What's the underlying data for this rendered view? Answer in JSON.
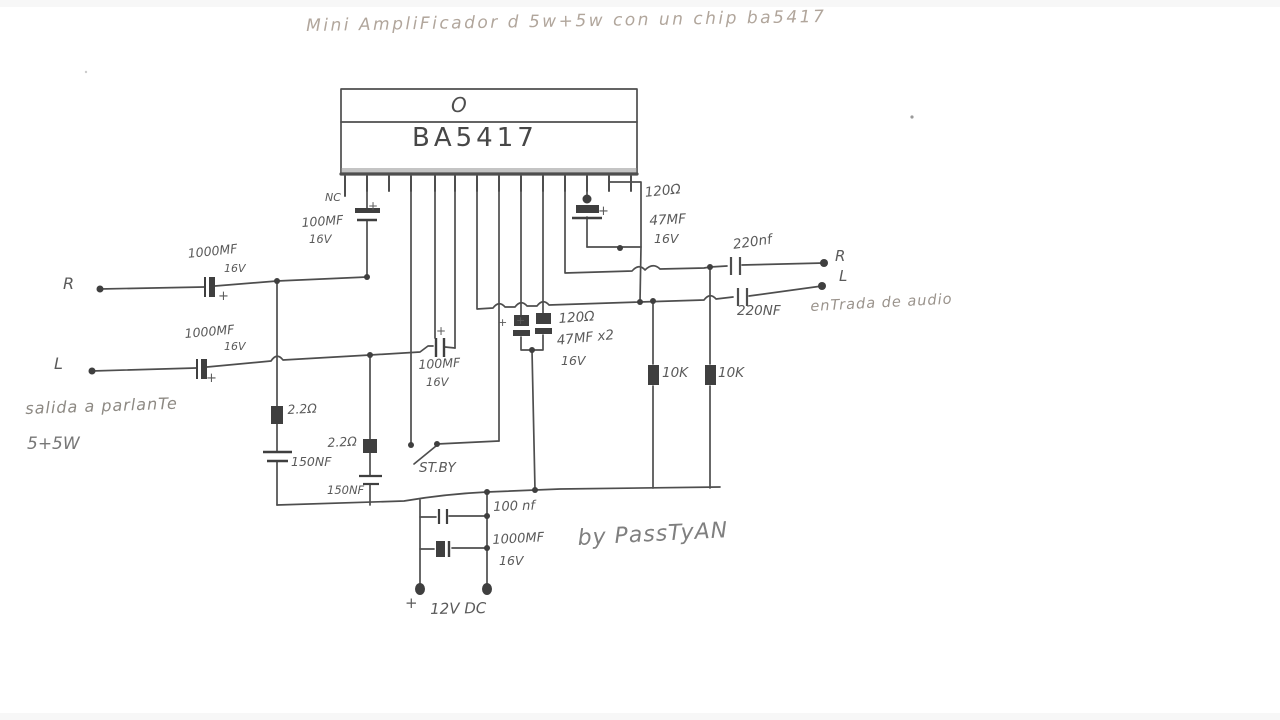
{
  "title": "Mini AmpliFicador d 5w+5w con un chip ba5417",
  "ic": {
    "part": "BA5417",
    "pin1_mark": "O"
  },
  "credit": "by PassTyAN",
  "polarity_mark": "+",
  "io": {
    "output_r": "R",
    "output_l": "L",
    "output_caption": "salida a parlanTe",
    "output_rating": "5+5W",
    "input_r": "R",
    "input_l": "L",
    "input_caption": "enTrada de audio"
  },
  "components": {
    "nc": "NC",
    "c_top_left": {
      "value": "100MF",
      "voltage": "16V"
    },
    "c_output_r": {
      "value": "1000MF",
      "voltage": "16V"
    },
    "c_output_l": {
      "value": "1000MF",
      "voltage": "16V"
    },
    "r_top_right": "120Ω",
    "c_top_right": {
      "value": "47MF",
      "voltage": "16V"
    },
    "c_mid": {
      "value": "100MF",
      "voltage": "16V"
    },
    "r_mid": "120Ω",
    "c_boot": {
      "value": "47MF x2",
      "voltage": "16V"
    },
    "r_bias_1": "10K",
    "r_bias_2": "10K",
    "r_zobel_a": "2.2Ω",
    "c_zobel_a": "150NF",
    "r_zobel_b": "2.2Ω",
    "c_zobel_b": "150NF",
    "standby": "ST.BY",
    "c_input_r": "220nf",
    "c_input_l": "220NF",
    "c_supply_small": "100 nf",
    "c_supply_large": {
      "value": "1000MF",
      "voltage": "16V"
    },
    "supply": "12V DC"
  },
  "colors": {
    "ink": "#4e4e4e",
    "label": "#5a5a5a",
    "title": "#b1a69c",
    "caption": "#8d8983",
    "credit": "#7f7f7f",
    "background": "#ffffff"
  }
}
